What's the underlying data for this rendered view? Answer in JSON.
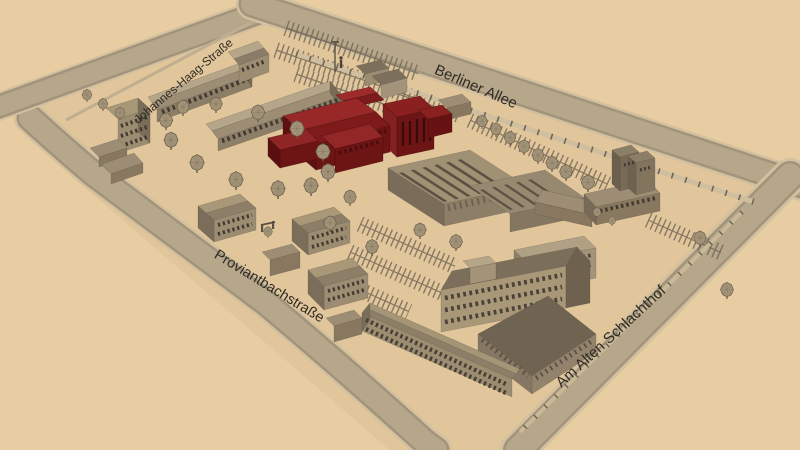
{
  "streets": [
    {
      "id": "johannes-haag-strasse",
      "label": "Johannes-Haag-Straße"
    },
    {
      "id": "berliner-allee",
      "label": "Berliner Allee"
    },
    {
      "id": "proviantbachstrasse",
      "label": "Proviantbachstraße"
    },
    {
      "id": "am-alten-schlachthof",
      "label": "Am Alten Schlachthof"
    }
  ],
  "highlighted_building": {
    "roof_color": "#8f2323",
    "wall_color": "#6d1414"
  },
  "colors": {
    "background": "#e8cca2",
    "site_ground": "#e2c69b",
    "road_surface": "#b6a78b",
    "road_curb": "#d2c09e",
    "building_wall": "#8d7e67",
    "building_roof": "#9c8d74",
    "tree": "#a39478",
    "label_text": "#2f2b24"
  }
}
